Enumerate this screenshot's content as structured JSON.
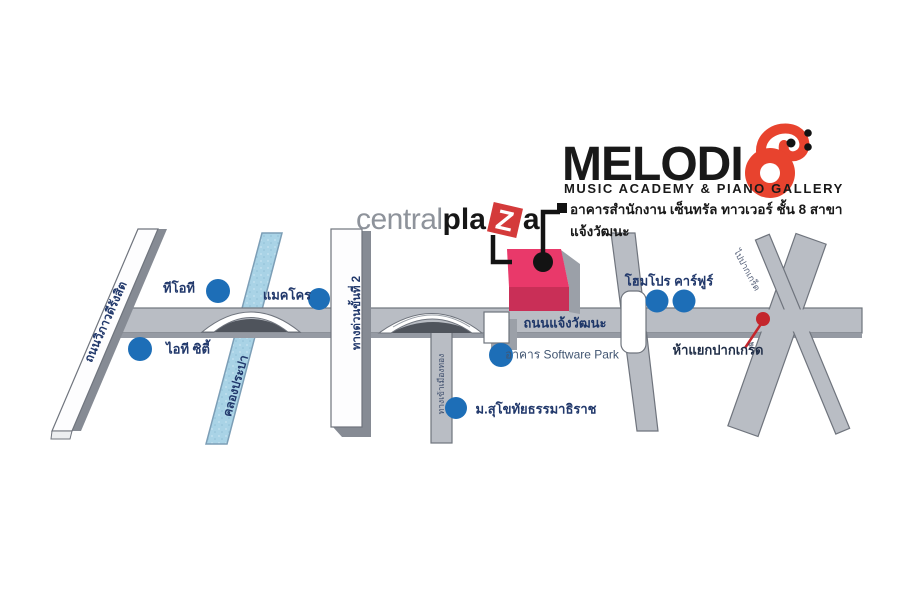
{
  "brand": {
    "wordmark_prefix": "MELODI",
    "wordmark_suffix_letter": "O",
    "full_name": "MELODIO",
    "tagline": "MUSIC ACADEMY & PIANO GALLERY",
    "address_line": "อาคารสำนักงาน เซ็นทรัล ทาวเวอร์ ชั้น 8 สาขาแจ้งวัฒนะ"
  },
  "centralplaza": {
    "part1": "central",
    "part2": "pla",
    "z_letter": "Z",
    "part3": "a"
  },
  "roads": {
    "chaengwattana": "ถนนแจ้งวัฒนะ",
    "vibhavadi": "ถนนวิภาวดีรังสิต",
    "canal": "คลองประปา",
    "expressway": "ทางด่วนขั้นที่ 2",
    "muangthong_entrance": "ทางเข้าเมืองทอง",
    "to_pakkret": "ไปปากเกร็ด"
  },
  "landmarks": {
    "tot": "ทีโอที",
    "it_city": "ไอที ซิตี้",
    "makro": "แมคโคร",
    "software_park": "อาคาร Software Park",
    "stou": "ม.สุโขทัยธรรมาธิราช",
    "homepro_carrefour": "โฮมโปร คาร์ฟูร์",
    "pakkret_junction": "ห้าแยกปากเกร็ด"
  },
  "colors": {
    "brand_red": "#e8432e",
    "plaza_red": "#d43a3a",
    "building_pink": "#e9396a",
    "building_front": "#c92f57",
    "poi_dot_blue": "#1d6eb7",
    "junction_red": "#c4262c",
    "label_navy": "#21386b",
    "road_gray": "#b9bdc4",
    "canal_blue": "#a9d3e6"
  }
}
